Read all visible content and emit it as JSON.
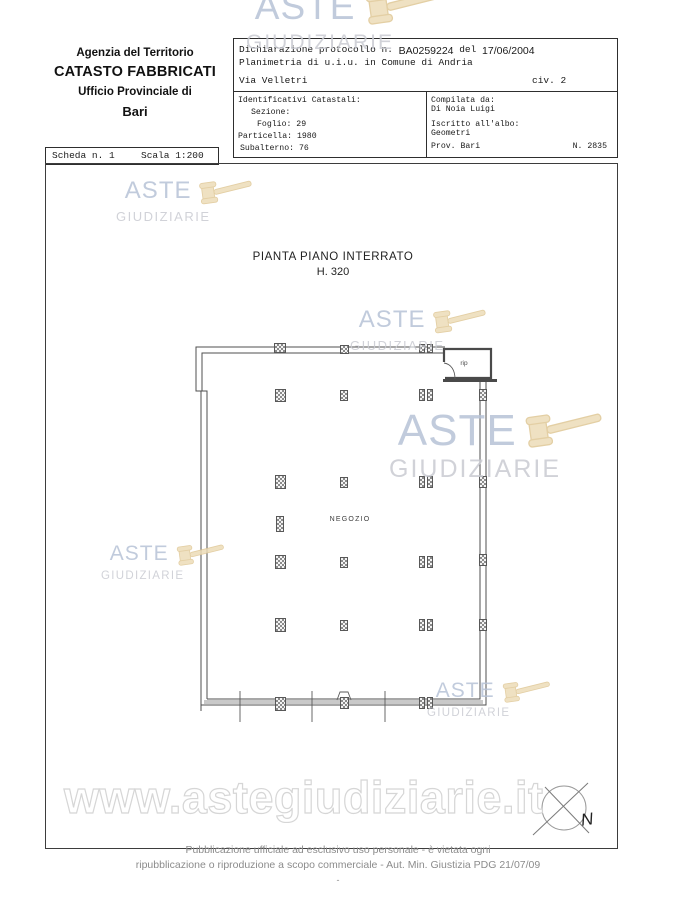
{
  "header": {
    "agency": "Agenzia del Territorio",
    "registry": "CATASTO FABBRICATI",
    "office": "Ufficio Provinciale di",
    "city": "Bari"
  },
  "scheda": {
    "number": "Scheda n. 1",
    "scale": "Scala 1:200"
  },
  "form": {
    "protocol_label": "Dichiarazione protocollo n.",
    "protocol_value": "BA0259224",
    "del_label": "del",
    "protocol_date": "17/06/2004",
    "planimetria_line": "Planimetria di u.i.u. in Comune di Andria",
    "street": "Via Velletri",
    "civic": "civ. 2",
    "cadastral": {
      "title": "Identificativi Catastali:",
      "sezione": "Sezione:",
      "foglio": "Foglio: 29",
      "particella": "Particella: 1980",
      "subalterno": "Subalterno: 76"
    },
    "compiler": {
      "title": "Compilata da:",
      "name": "Di Noia Luigi",
      "register_label": "Iscritto all'albo:",
      "register": "Geometri",
      "prov": "Prov. Bari",
      "number": "N. 2835"
    }
  },
  "plan": {
    "title": "PIANTA PIANO INTERRATO",
    "height_label": "H. 320",
    "room_label": "NEGOZIO",
    "closet_label": "rip",
    "compass_label": "N"
  },
  "watermark": {
    "line1": "ASTE",
    "line2": "GIUDIZIARIE",
    "url": "www.astegiudiziarie.it"
  },
  "footer": {
    "line1": "Pubblicazione ufficiale ad esclusivo uso personale - è vietata ogni",
    "line2": "ripubblicazione o riproduzione a scopo commerciale - Aut. Min. Giustizia PDG 21/07/09",
    "line3": "-"
  },
  "colors": {
    "aste": "#b7c3d7",
    "giudiziarie": "#c9cbd2",
    "gavel": "#eddcb8",
    "gavel_outline": "#dfc795",
    "footer_text": "#8c8c8c"
  }
}
